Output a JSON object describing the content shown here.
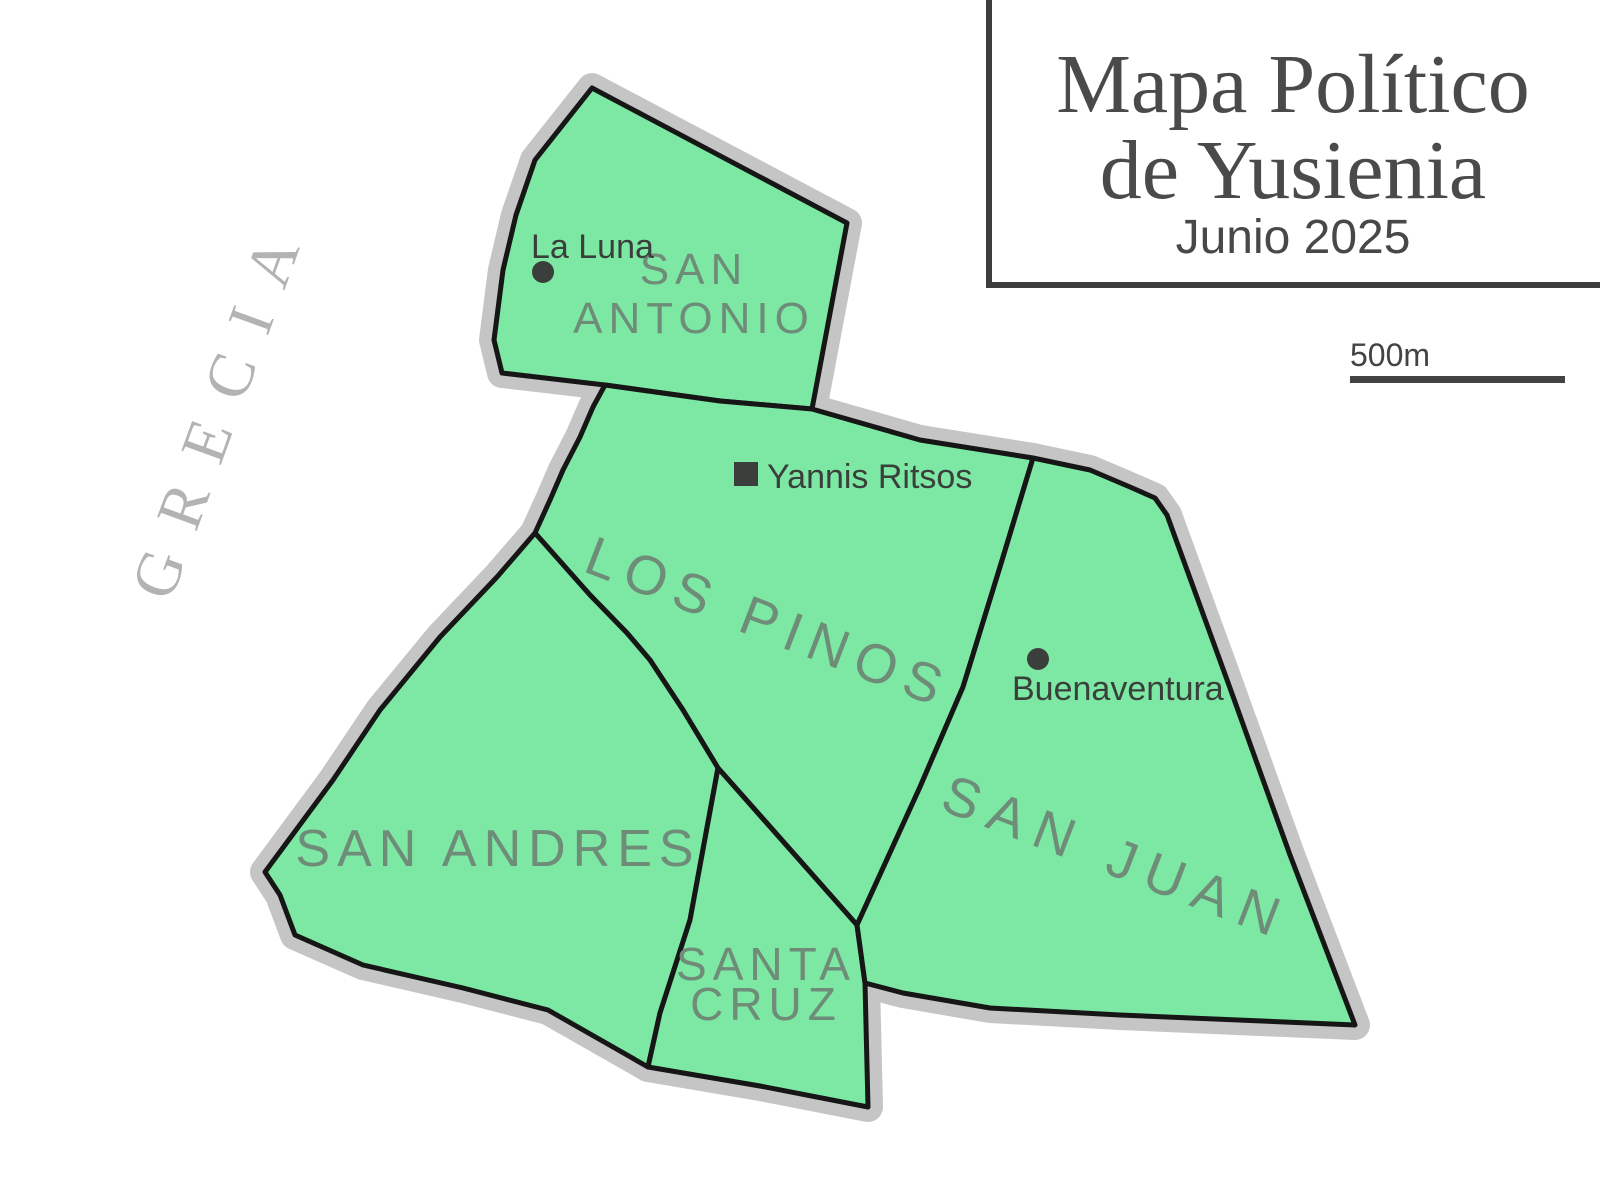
{
  "title_box": {
    "line1": "Mapa Político",
    "line2": "de Yusienia",
    "subtitle": "Junio 2025"
  },
  "scale": {
    "label": "500m"
  },
  "background_label": "GRECIA",
  "colors": {
    "region_fill": "#7ce8a3",
    "region_border": "#161616",
    "region_casing": "#c5c5c5",
    "region_label": "#6e8c78",
    "city_label": "#3a3f3c",
    "title_text": "#4a4a4a",
    "title_border": "#3d3d3d",
    "scale_bar": "#434343",
    "background_label_color": "#b3b3b3"
  },
  "map": {
    "regions": [
      {
        "name": "San Antonio",
        "points": "592,88 847,223 812,409 720,401 605,385 502,373 494,340 503,270 516,215 535,160",
        "label": {
          "lines": [
            "SAN",
            "ANTONIO"
          ],
          "x": 694,
          "y": 284,
          "rotate": 0,
          "size": 44,
          "spacing": 6,
          "line_gap": 49
        }
      },
      {
        "name": "Los Pinos",
        "points": "605,385 720,401 812,409 920,440 1033,458 1000,567 963,687 920,787 857,925 718,768 683,710 650,660 627,633 590,595 535,533 550,500 563,470 580,437 593,407",
        "label": {
          "lines": [
            "LOS PINOS"
          ],
          "x": 762,
          "y": 640,
          "rotate": 21,
          "size": 55,
          "spacing": 10
        }
      },
      {
        "name": "San Andres",
        "points": "535,533 590,595 627,633 650,660 683,710 718,768 690,920 660,1013 648,1067 613,1047 548,1010 463,988 363,965 295,935 280,895 265,872 333,780 380,710 440,637 497,577",
        "label": {
          "lines": [
            "SAN ANDRES"
          ],
          "x": 498,
          "y": 866,
          "rotate": 0,
          "size": 52,
          "spacing": 7
        }
      },
      {
        "name": "Santa Cruz",
        "points": "718,768 857,925 865,983 868,1107 760,1086 648,1067 660,1013 690,920",
        "label": {
          "lines": [
            "SANTA",
            "CRUZ"
          ],
          "x": 766,
          "y": 980,
          "rotate": 0,
          "size": 46,
          "spacing": 6,
          "line_gap": 40
        }
      },
      {
        "name": "San Juan",
        "points": "1033,458 1090,470 1130,487 1155,498 1167,515 1230,688 1290,855 1355,1025 1120,1015 990,1008 903,993 865,983 857,925 920,787 963,687 1000,567",
        "label": {
          "lines": [
            "SAN JUAN"
          ],
          "x": 1110,
          "y": 875,
          "rotate": 21,
          "size": 55,
          "spacing": 12
        }
      }
    ],
    "cities": [
      {
        "name": "La Luna",
        "marker": "dot",
        "x": 543,
        "y": 272,
        "label_x": 531,
        "label_y": 258
      },
      {
        "name": "Yannis Ritsos",
        "marker": "square",
        "x": 746,
        "y": 474,
        "label_x": 767,
        "label_y": 488
      },
      {
        "name": "Buenaventura",
        "marker": "dot",
        "x": 1038,
        "y": 659,
        "label_x": 1012,
        "label_y": 700
      }
    ]
  }
}
